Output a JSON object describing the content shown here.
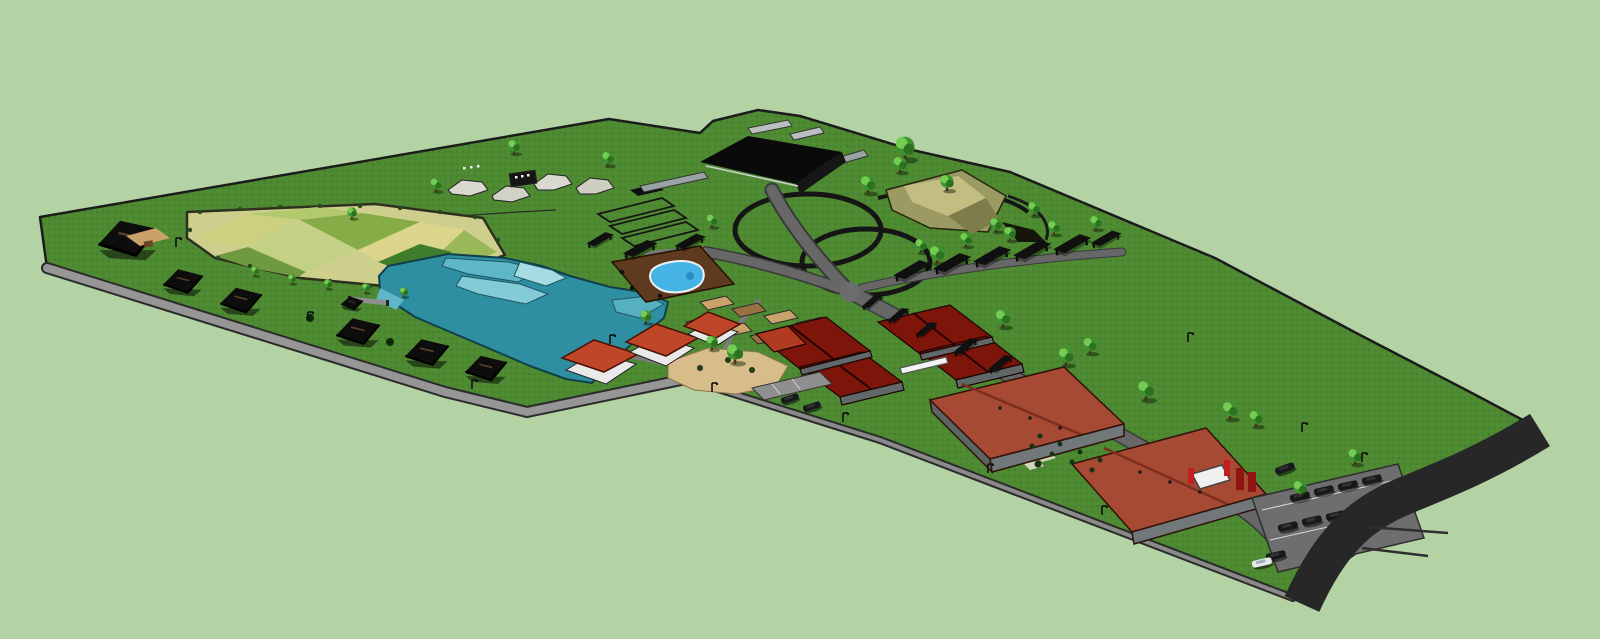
{
  "scene": {
    "description": "Aerial 3D site-plan render of a farm resort campus",
    "features": [
      "perimeter asphalt road",
      "gravel lane",
      "crop field patchwork",
      "ornamental lake with terraces",
      "guest cottages",
      "swimming pool deck",
      "vegetable plots",
      "sand plaza",
      "tiled-roof halls",
      "terracotta warehouses",
      "main pavilion",
      "riding tracks",
      "animal pens",
      "rock garden hill",
      "pergola row",
      "parking lot",
      "trees",
      "lamp posts"
    ],
    "colors": {
      "background": "#b3d3a5",
      "grass": "#4e8a31",
      "grass_outline": "#1b1b1b",
      "lake": "#2e8fa2",
      "lake_terrace": "#5fb6c6",
      "lake_terrace_light": "#83cbd6",
      "pool": "#45b4e4",
      "deck": "#5e3a1e",
      "sand_plaza": "#d6bd8a",
      "soil_plot": "#caa36b",
      "soil_plot_dark": "#9a7142",
      "field_base": "#cfcf8d",
      "field_patches": [
        "#ccd17f",
        "#b3c96e",
        "#86ab47",
        "#c2d184",
        "#dcd68d",
        "#9bb858",
        "#6f9a3f",
        "#3f7c2c"
      ],
      "roof_red": "#c0462a",
      "roof_tile_dark": "#7d150b",
      "roof_terracotta": "#a64a34",
      "wall_white": "#e9e9e9",
      "wall_gray": "#60686a",
      "building_dark": "#0d0d0d",
      "road_asphalt": "#272727",
      "road_gravel": "#969696",
      "rock_tan": "#9c9a63",
      "tree_crown": "#3e9230",
      "tree_highlight": "#74cc52"
    }
  }
}
